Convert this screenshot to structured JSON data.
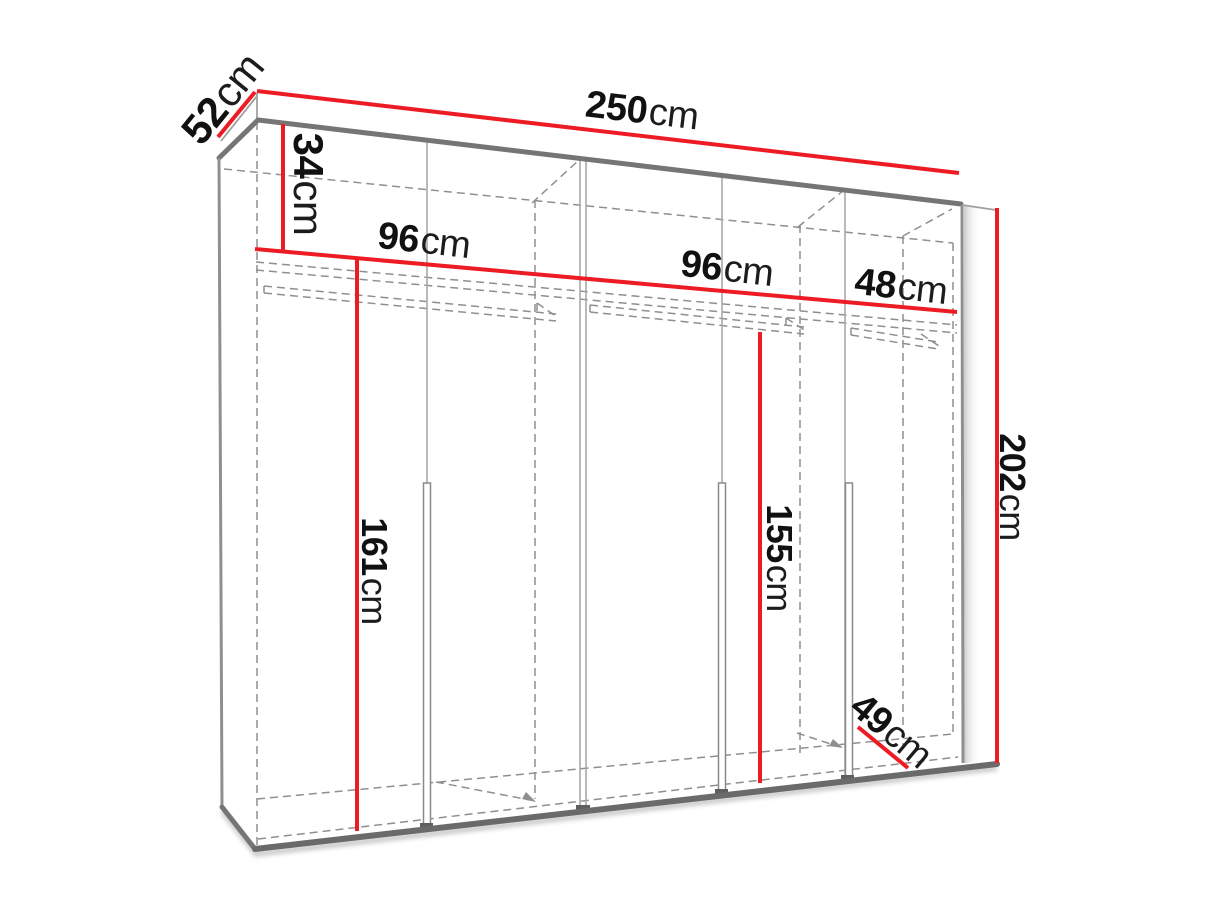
{
  "diagram": {
    "subject": "wardrobe-dimension-diagram",
    "unit": "cm",
    "colors": {
      "dimension_red": "#ED1C24",
      "edge_gray": "#757575",
      "hidden_line_gray": "#8f8f8f",
      "label_black": "#111111",
      "background": "#ffffff"
    }
  },
  "dimensions": {
    "width": {
      "value": "250",
      "unit": "cm"
    },
    "depth": {
      "value": "52",
      "unit": "cm"
    },
    "height": {
      "value": "202",
      "unit": "cm"
    },
    "top_section_height": {
      "value": "34",
      "unit": "cm"
    },
    "left_section_width": {
      "value": "96",
      "unit": "cm"
    },
    "middle_section_width": {
      "value": "96",
      "unit": "cm"
    },
    "right_section_width": {
      "value": "48",
      "unit": "cm"
    },
    "left_interior_height": {
      "value": "161",
      "unit": "cm"
    },
    "middle_interior_height": {
      "value": "155",
      "unit": "cm"
    },
    "interior_depth": {
      "value": "49",
      "unit": "cm"
    }
  }
}
